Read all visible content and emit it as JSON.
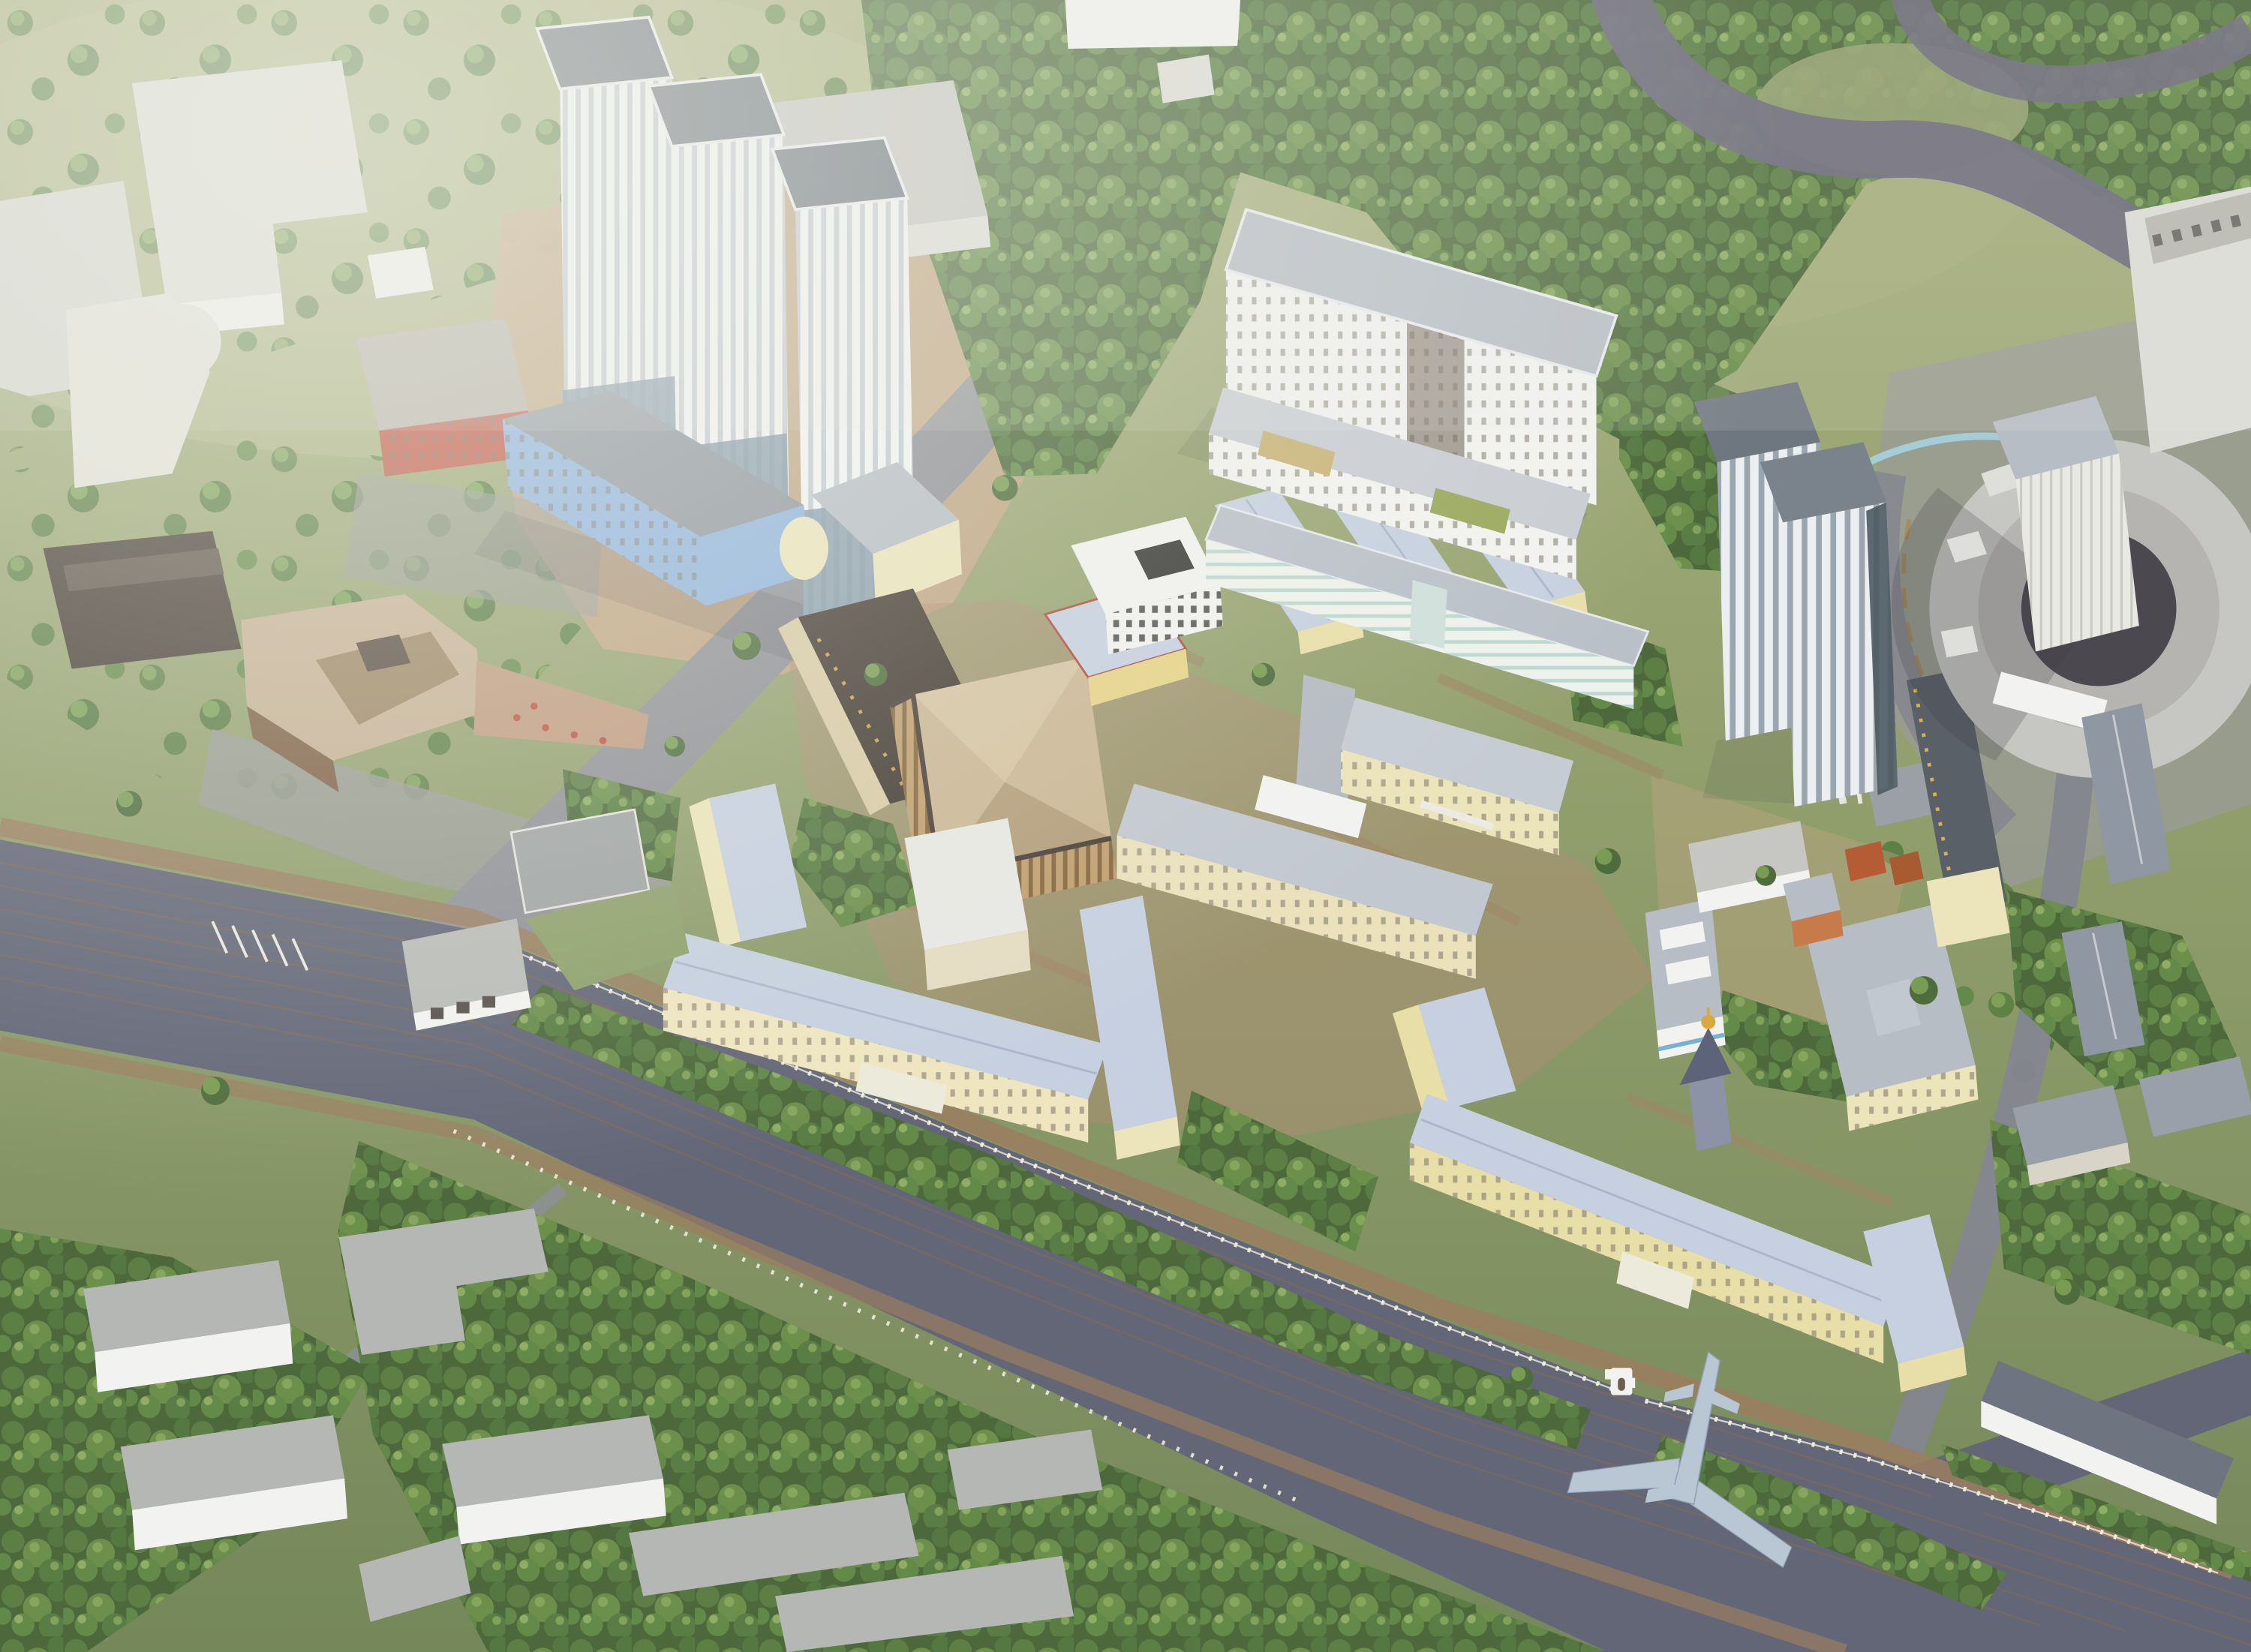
{
  "scene": {
    "title": "Aerial bird's-eye 3D architectural rendering of a green campus district with residential towers, hospital and university buildings, a circular arena under massing study, a diagonal boulevard with an airplane monument, forests and a meandering river",
    "type": "architectural-visualization",
    "view": "bird's-eye oblique",
    "time_of_day": "hazy daylight"
  },
  "landmarks": [
    {
      "name": "residential-towers",
      "description": "three white high-rise towers with striped facades and blue-gray bases on sandy ground"
    },
    {
      "name": "school-building",
      "description": "red-orange low building with glazed grid facade"
    },
    {
      "name": "university-building",
      "description": "light-blue slab with white stripes and round pale-yellow corner tower"
    },
    {
      "name": "culture-center",
      "description": "curved tan/brown building with glass facade and terrace with red round tables"
    },
    {
      "name": "dark-depot",
      "description": "dark brown barrel-roof depot at far left"
    },
    {
      "name": "central-palace",
      "description": "trapezoidal colonnaded hall with faceted tan roof"
    },
    {
      "name": "dark-long-building",
      "description": "long building with nearly black roof and gilded dormers"
    },
    {
      "name": "dormitory-slab",
      "description": "large white multi-storey slab with gray flat roof and low white wings"
    },
    {
      "name": "mint-long-building",
      "description": "long 4-storey building with mint striped facade"
    },
    {
      "name": "cream-u-hospital",
      "description": "U-shaped cream classical building with pale blue hip roof"
    },
    {
      "name": "yellow-u-hospital",
      "description": "U-shaped yellow building with pale blue hip roof and white portico"
    },
    {
      "name": "chapel",
      "description": "small chapel with dark tent roof and golden onion dome"
    },
    {
      "name": "striped-highrise",
      "description": "tall twin-slab tower with vertical white/gray stripes"
    },
    {
      "name": "boiler-house",
      "description": "cyan utility box with red-and-white striped chimney"
    },
    {
      "name": "concrete-arena",
      "description": "large circular untextured concrete massing with slab tower"
    },
    {
      "name": "airplane-monument",
      "description": "gray airplane silhouette across the boulevard at the campus gate"
    },
    {
      "name": "campus-fence",
      "description": "white fence with regular pillars along the boulevard"
    },
    {
      "name": "boulevard",
      "description": "wide diagonal dark asphalt road with thin brown lane lines"
    },
    {
      "name": "river",
      "description": "dark meandering river in the top-right forest"
    },
    {
      "name": "forest",
      "description": "dense green tree cover across the district"
    }
  ],
  "colors": {
    "grass": "#95a170",
    "grassLight": "#b4ba8a",
    "forest": "#4d683b",
    "river": "#6e6b7c",
    "roadAsphalt": "#636677",
    "roadGray": "#84868f",
    "laneLine": "#8a6a4e",
    "plazaGray": "#9a9b98",
    "dirtSand": "#c2a584",
    "plazaRose": "#b28f75",
    "pathBrown": "#9b7e60",
    "wallWhite": "#f2f2f0",
    "wallShade": "#dcdcd6",
    "roofGray": "#b7bdc5",
    "roofDark": "#6e7680",
    "roofPaleBlue": "#c6d0e0",
    "wallCream": "#ece4ba",
    "wallYellow": "#e8dfa8",
    "facadeBlue": "#8fb3de",
    "facadeRed": "#c05746",
    "theaterRoof": "#c6b094",
    "theaterWall": "#7d5f45",
    "darkRoof": "#453c34",
    "palaceRoof": "#cbb795",
    "towerBase": "#7d93a3",
    "concrete": "#c6c6c2",
    "arenaCourt": "#4c4850",
    "cyanUtility": "#29b5d6",
    "chimneyRed": "#c0503e",
    "gold": "#d9a83f",
    "airplane": "#b9c6d4",
    "fence": "#f0ecdc"
  }
}
